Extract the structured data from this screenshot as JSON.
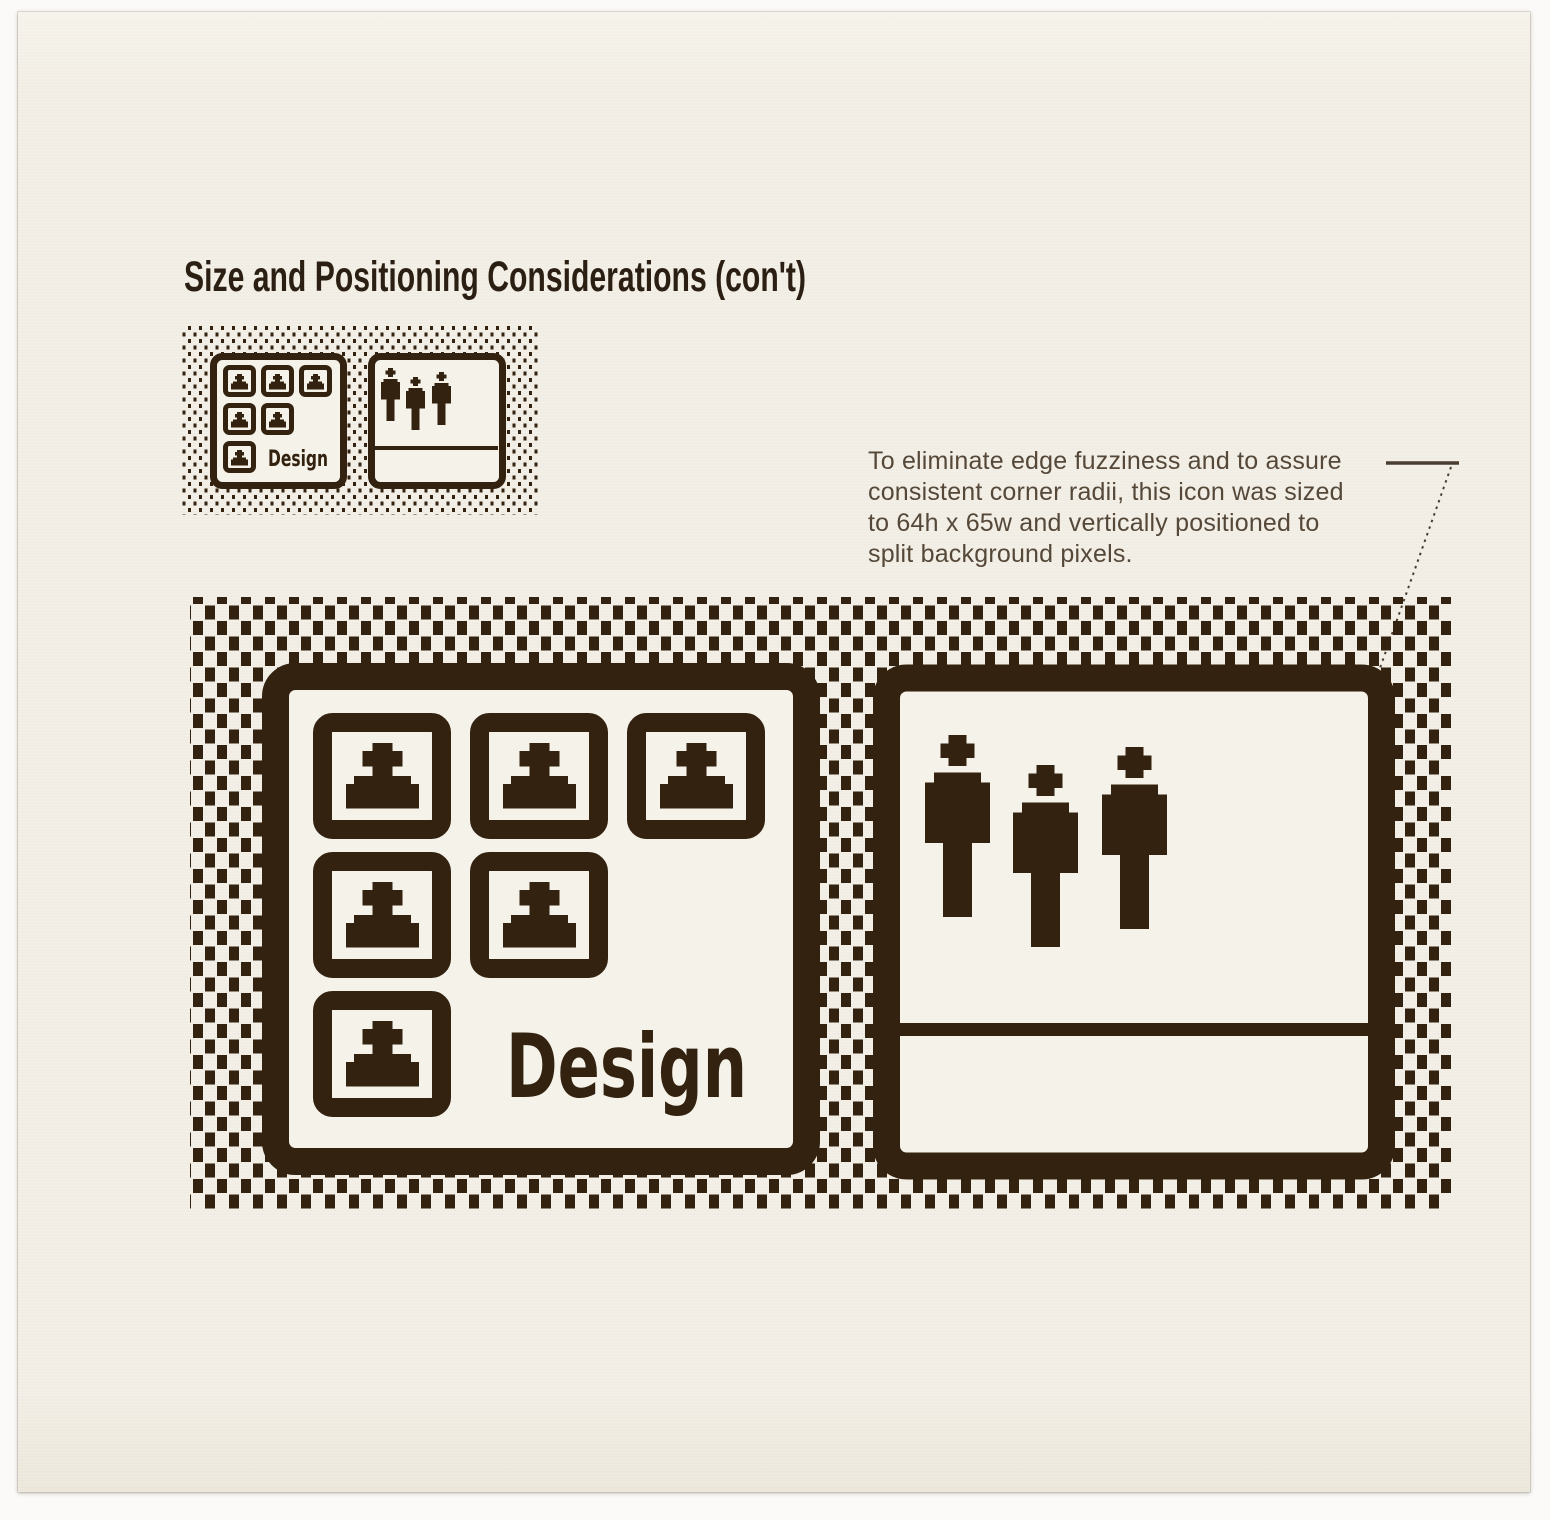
{
  "page": {
    "title": "Size and Positioning Considerations (con't)"
  },
  "annotation": {
    "lines": [
      "To eliminate edge fuzziness and to assure",
      "consistent corner radii, this icon was sized",
      "to 64h x 65w and vertically positioned to",
      "split background pixels."
    ]
  },
  "labels": {
    "design_small": "Design",
    "design_large": "Design"
  },
  "icons": {
    "left_icon": "design-group-window-icon",
    "right_icon": "people-icon",
    "repeated_glyphs": [
      "portrait-bust-icon",
      "person-figure-icon"
    ]
  },
  "colors": {
    "paper": "#f1ede4",
    "paper_bright": "#f5f2ea",
    "ink": "#33220f",
    "title_text": "#2a1f12",
    "annotation_text": "#554839",
    "leader_line": "#4a3e30"
  }
}
